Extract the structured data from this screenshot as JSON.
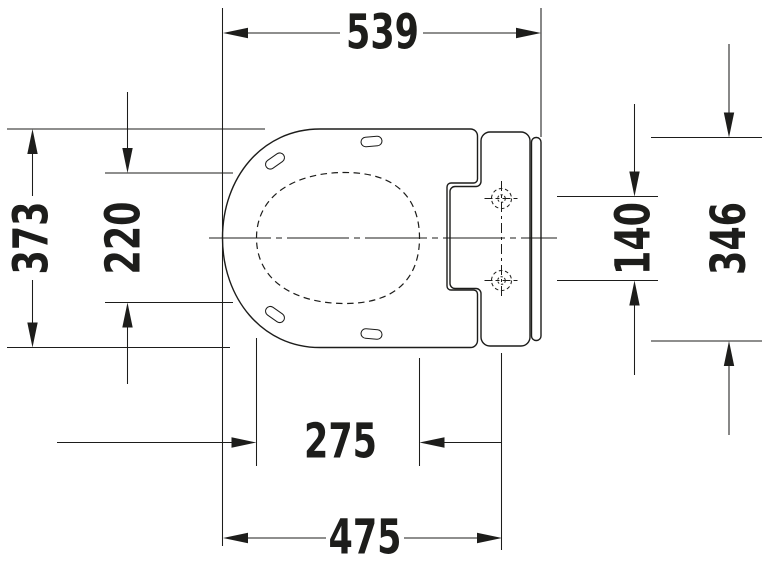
{
  "meta": {
    "background_color": "#ffffff",
    "line_color": "#1d1d1b",
    "drawing_type": "technical dimension drawing, toilet seat top view"
  },
  "dims": {
    "top": "539",
    "left_outer": "373",
    "left_inner": "220",
    "right_inner": "140",
    "right_outer": "346",
    "bottom_inner": "275",
    "bottom_outer": "475"
  }
}
